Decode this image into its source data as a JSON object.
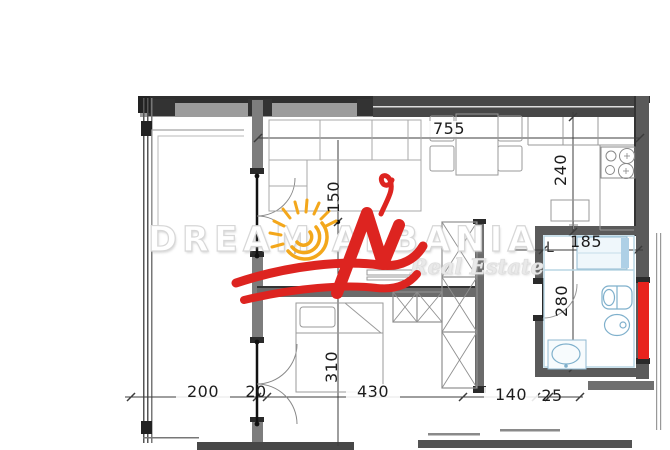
{
  "watermark": {
    "line1": "DREAM",
    "line2": "ALBANIA",
    "tagline": "Real Estate"
  },
  "dims": {
    "d755": "755",
    "d240": "240",
    "d185": "185",
    "d280": "280",
    "d150": "150",
    "d310": "310",
    "d200": "200",
    "d20": "20",
    "d430": "430",
    "d140": "140",
    "d25": "25"
  },
  "labels": {
    "laundry": "L"
  },
  "colors": {
    "logo_red": "#dd2420",
    "logo_yellow": "#f3a71b",
    "highlight_red": "#e8231d",
    "wall_dark": "#3a3a3a",
    "wall_gray": "#8a8a8a",
    "fixture_blue": "#7fb0cc"
  }
}
